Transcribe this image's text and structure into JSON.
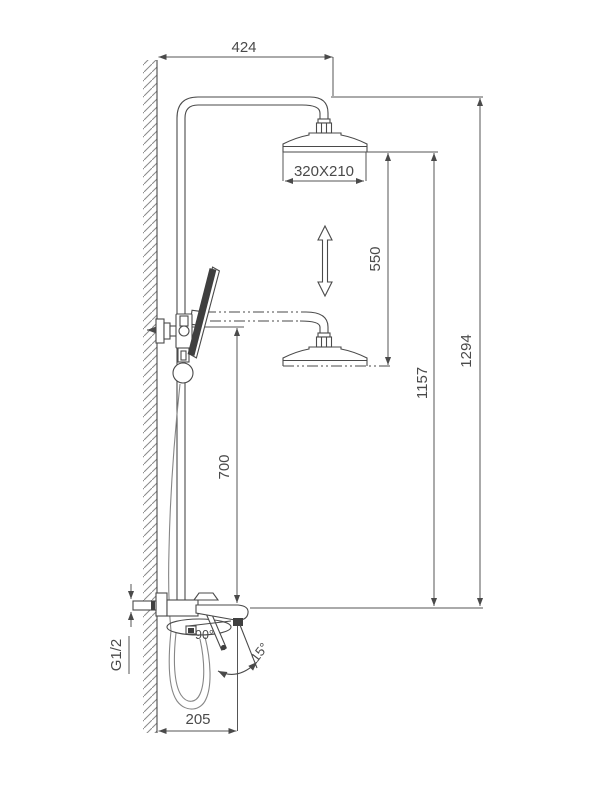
{
  "drawing": {
    "dimensions": {
      "top_offset": "424",
      "head_size": "320X210",
      "head_travel": "550",
      "head_height": "1157",
      "total_height": "1294",
      "bracket_to_mixer": "700",
      "inlet_thread": "G1/2",
      "handle_rotation": "90°",
      "spout_tilt": "15°",
      "spout_reach": "205"
    },
    "colors": {
      "line": "#4a4a4a",
      "light_line": "#868686",
      "dark_fill": "#3f3f3f",
      "background": "#ffffff"
    }
  }
}
